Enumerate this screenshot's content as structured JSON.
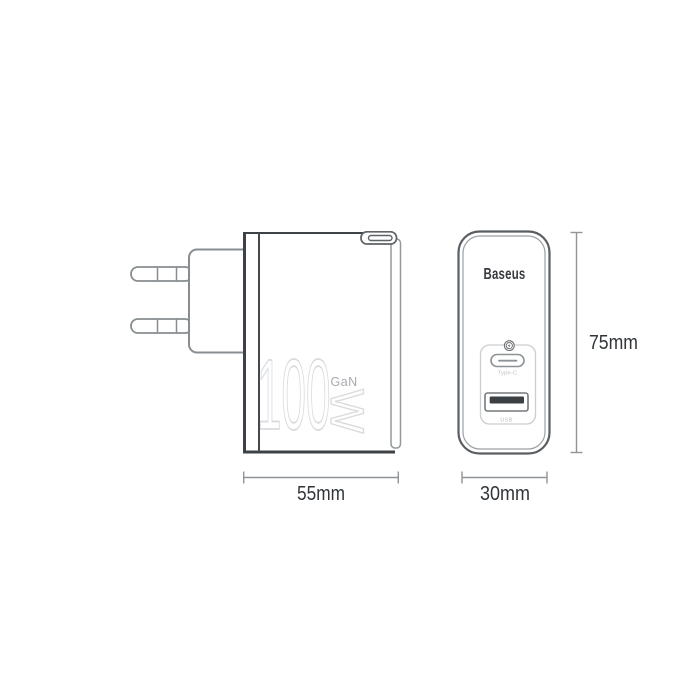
{
  "product": {
    "brand": "Baseus",
    "power": "100",
    "power_unit": "W",
    "technology": "GaN"
  },
  "front_view": {
    "brand_label": "Baseus",
    "fast_charge_icon": "lightning-circle-icon",
    "type_c_port_label": "Type-C",
    "usb_port_label": "USB"
  },
  "dimensions": {
    "side_width": "55mm",
    "front_width": "30mm",
    "height": "75mm"
  },
  "colors": {
    "background": "#ffffff",
    "line_dark": "#3d4246",
    "line_medium": "#888d91",
    "line_light": "#cbcdd0",
    "back_plate_line": "#92989c",
    "watermark_stroke": "#d8dadc",
    "gan_text": "#a7abae",
    "brand_text": "#363b40",
    "dim_line": "#8f9498",
    "dim_label": "#303539",
    "port_label": "#b9bdc0",
    "usb_tongue": "#3b4044"
  }
}
